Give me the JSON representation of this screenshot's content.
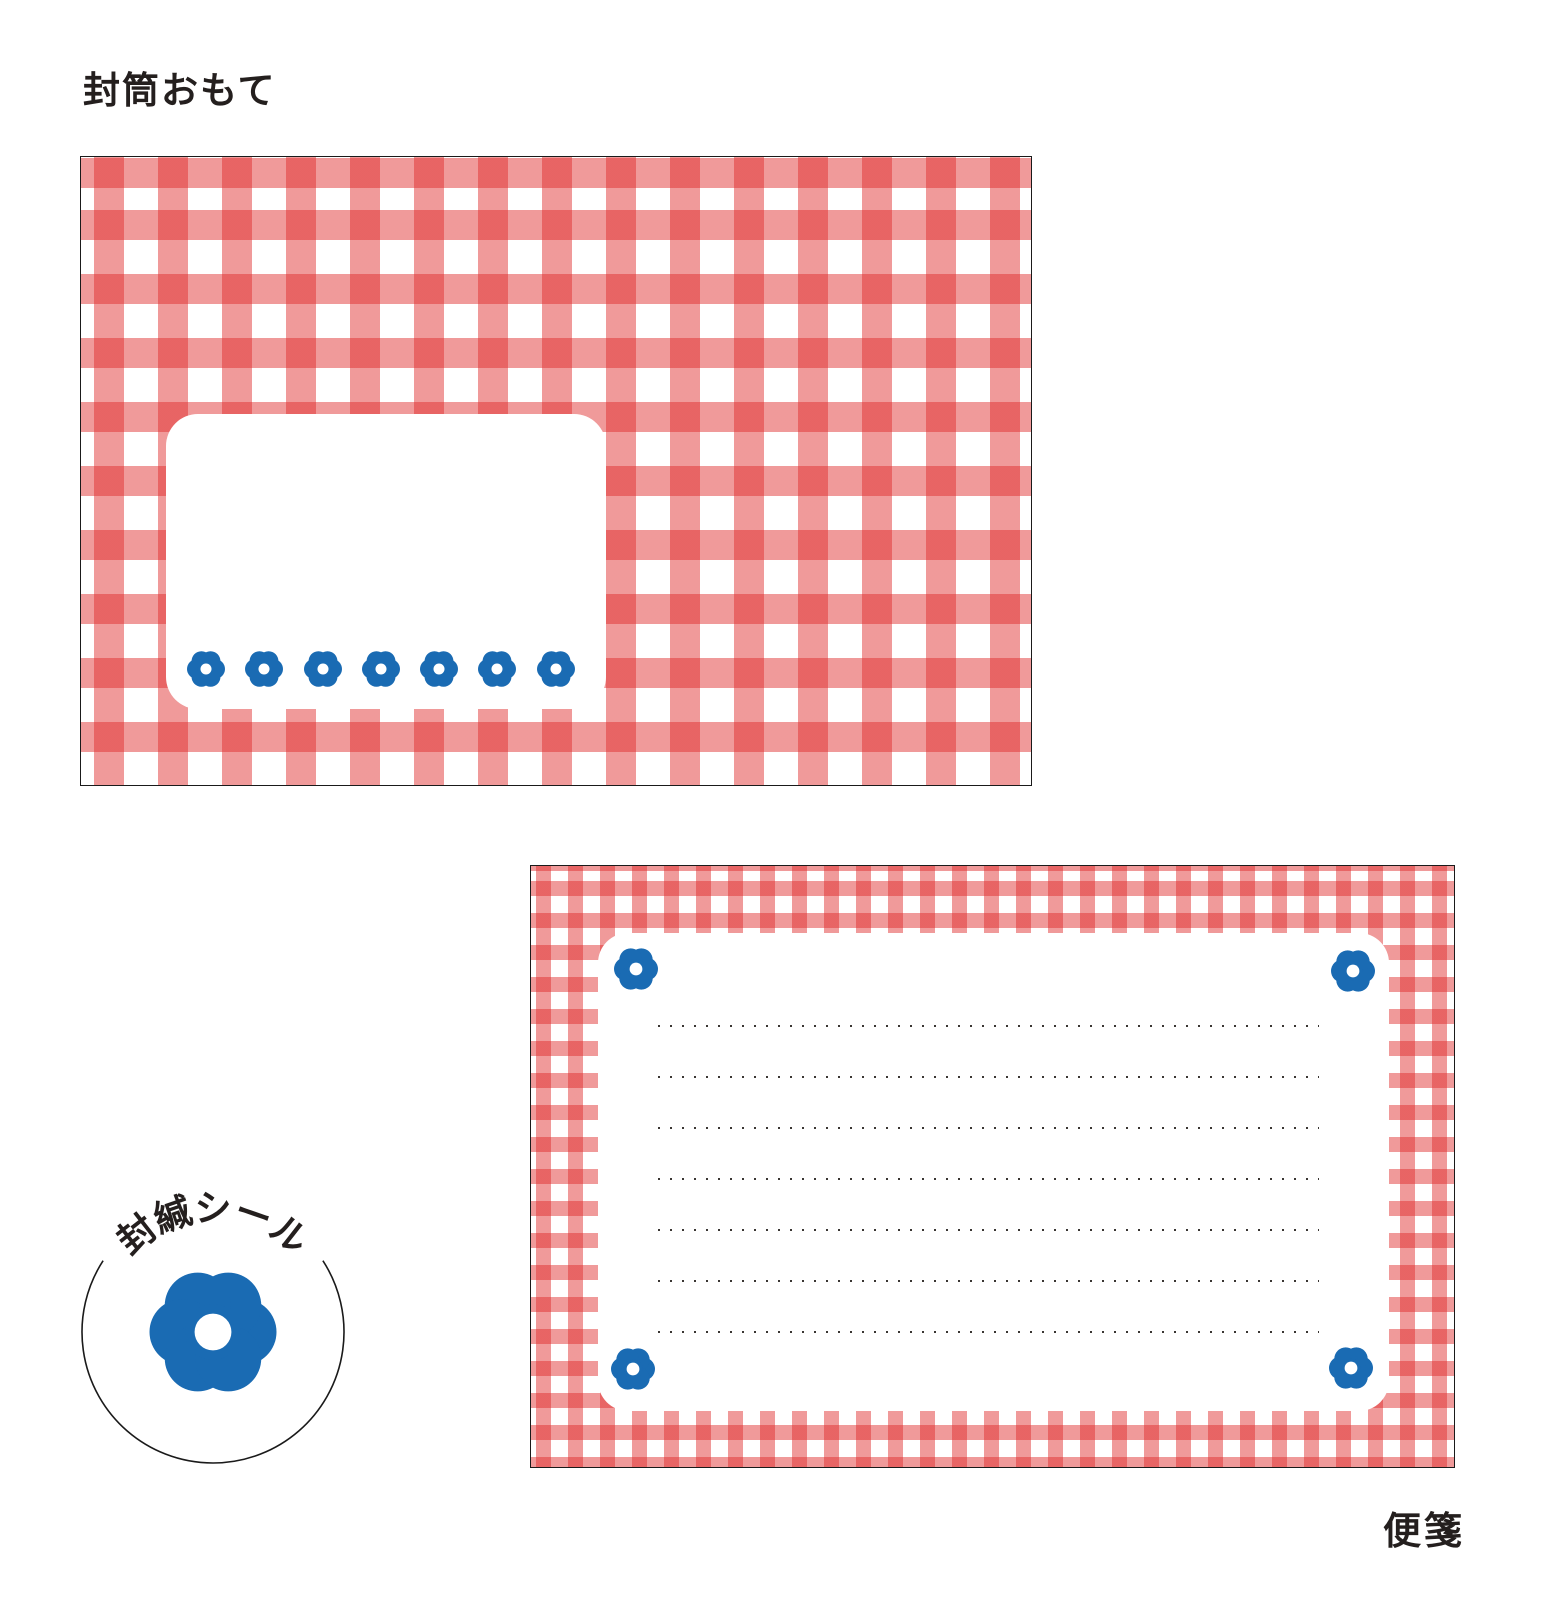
{
  "labels": {
    "envelope_front": "封筒おもて",
    "letter_paper": "便箋"
  },
  "seal": {
    "text": "封緘シール",
    "chars": [
      "封",
      "緘",
      "シ",
      "ー",
      "ル"
    ],
    "char_angles_deg": [
      -38,
      -19,
      0,
      19,
      38
    ]
  },
  "envelope": {
    "address_flower_count": 7
  },
  "letter": {
    "dotted_line_count": 7,
    "line_spacing_px": 51,
    "corner_flower_count": 4
  },
  "colors": {
    "gingham_red_light": "#F09A9A",
    "gingham_red_overlap": "#E05C5C",
    "flower_blue": "#1A6BB3",
    "outline_black": "#1A1A1A",
    "text_dark": "#241F1E",
    "dot_gray": "#3A3633"
  },
  "icons": {
    "flower": "six-petal-flower"
  }
}
